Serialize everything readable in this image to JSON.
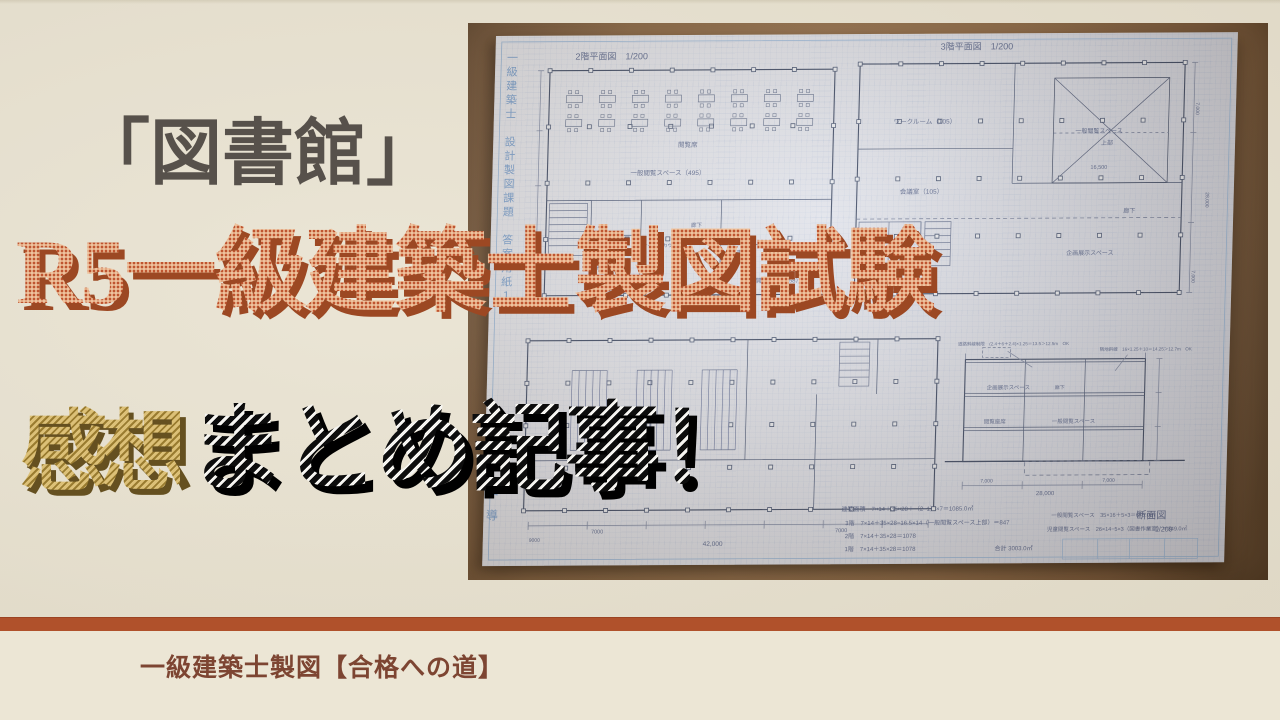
{
  "overlay": {
    "line1": "「図書館」",
    "line2": "R5一級建築士製図試験",
    "line3_gold": "感想",
    "line3_black": "まとめ記事！"
  },
  "footer": {
    "channel_name": "一級建築士製図【合格への道】"
  },
  "colors": {
    "background": "#e9e3d2",
    "accent_bar": "#b0512b",
    "footer_bg": "#ece6d5",
    "line1_text": "#57514b",
    "line2_orange": "#bf5530",
    "line2_shadow": "#9c4823",
    "gold": "#c9a853",
    "gold_shadow": "#655020",
    "black_stripe": "#0d0d0d",
    "channel_text": "#7d4532",
    "board_wood": "#9c744c",
    "paper": "#e2e5ee",
    "pencil_ink": "#5c6a88",
    "margin_blue": "#7aa3d4"
  },
  "photo": {
    "side_text_top": "一級建築士　設計製図課題　答案用紙１",
    "side_text_bottom": "ウラ指導",
    "plan_labels": [
      {
        "text": "2階平面図　1/200",
        "x": 80,
        "y": 24,
        "s": 9
      },
      {
        "text": "3階平面図　1/200",
        "x": 445,
        "y": 16,
        "s": 9
      },
      {
        "text": "断面図",
        "x": 653,
        "y": 486,
        "s": 10
      },
      {
        "text": "1/200",
        "x": 672,
        "y": 499,
        "s": 7
      },
      {
        "text": "閲覧席",
        "x": 185,
        "y": 112,
        "s": 6.5
      },
      {
        "text": "一般閲覧スペース（495）",
        "x": 138,
        "y": 140,
        "s": 6.5
      },
      {
        "text": "廊下",
        "x": 200,
        "y": 192,
        "s": 5.5
      },
      {
        "text": "サービスカウンター",
        "x": 152,
        "y": 212,
        "s": 5
      },
      {
        "text": "司書研究室（28）",
        "x": 96,
        "y": 234,
        "s": 5.5
      },
      {
        "text": "図書作業室（20）",
        "x": 116,
        "y": 256,
        "s": 5.5
      },
      {
        "text": "書庫",
        "x": 246,
        "y": 220,
        "s": 6
      },
      {
        "text": "開架書庫（158）",
        "x": 266,
        "y": 248,
        "s": 6
      },
      {
        "text": "ワークルーム（105）",
        "x": 400,
        "y": 90,
        "s": 6.5
      },
      {
        "text": "会議室（105）",
        "x": 408,
        "y": 160,
        "s": 6.5
      },
      {
        "text": "一般閲覧スペース",
        "x": 582,
        "y": 100,
        "s": 6
      },
      {
        "text": "上部",
        "x": 608,
        "y": 112,
        "s": 6
      },
      {
        "text": "16,500",
        "x": 598,
        "y": 136,
        "s": 5.5
      },
      {
        "text": "廊下",
        "x": 632,
        "y": 180,
        "s": 6
      },
      {
        "text": "企画展示スペース",
        "x": 576,
        "y": 222,
        "s": 6
      },
      {
        "text": "7,000",
        "x": 702,
        "y": 70,
        "s": 5,
        "rot": 90
      },
      {
        "text": "28,000",
        "x": 714,
        "y": 160,
        "s": 5,
        "rot": 90
      },
      {
        "text": "7,000",
        "x": 702,
        "y": 238,
        "s": 5,
        "rot": 90
      },
      {
        "text": "9000",
        "x": 46,
        "y": 506,
        "s": 5
      },
      {
        "text": "7000",
        "x": 108,
        "y": 498,
        "s": 5.5
      },
      {
        "text": "7000",
        "x": 352,
        "y": 498,
        "s": 5.5
      },
      {
        "text": "42,000",
        "x": 220,
        "y": 511,
        "s": 6.5
      },
      {
        "text": "企画展示スペース",
        "x": 500,
        "y": 356,
        "s": 5.5
      },
      {
        "text": "廊下",
        "x": 568,
        "y": 356,
        "s": 5
      },
      {
        "text": "一般閲覧スペース",
        "x": 566,
        "y": 390,
        "s": 5.5
      },
      {
        "text": "閲覧座席",
        "x": 498,
        "y": 390,
        "s": 5.5
      },
      {
        "text": "7,000",
        "x": 496,
        "y": 449,
        "s": 5
      },
      {
        "text": "7,000",
        "x": 618,
        "y": 449,
        "s": 5
      },
      {
        "text": "28,000",
        "x": 552,
        "y": 462,
        "s": 6
      },
      {
        "text": "道路斜線制限　(2.4＋6＋2.4)×1.25＝13.5＞12.5m　OK",
        "x": 470,
        "y": 312,
        "s": 4.5
      },
      {
        "text": "隣地斜線　16×1.25＋10＝14.25＞12.7m　OK",
        "x": 612,
        "y": 318,
        "s": 4.5
      },
      {
        "text": "建築面積　7×14＋35×28＋（2−1）×7＝1085.0㎡",
        "x": 358,
        "y": 477,
        "s": 6
      },
      {
        "text": "3階　7×14＋35×28−16.5×14（一般閲覧スペース上部）＝847",
        "x": 362,
        "y": 491,
        "s": 6
      },
      {
        "text": "2階　7×14＋35×28＝1078",
        "x": 362,
        "y": 504,
        "s": 6
      },
      {
        "text": "1階　7×14＋35×28＝1078",
        "x": 362,
        "y": 517,
        "s": 6
      },
      {
        "text": "合計 3003.0㎡",
        "x": 512,
        "y": 517,
        "s": 6
      },
      {
        "text": "一般閲覧スペース　35×16＋5×3＝675.0㎡",
        "x": 568,
        "y": 484,
        "s": 5.5
      },
      {
        "text": "児童閲覧スペース　26×14−5×3（図書作業室）＝349.0㎡",
        "x": 564,
        "y": 498,
        "s": 5.5
      }
    ]
  }
}
